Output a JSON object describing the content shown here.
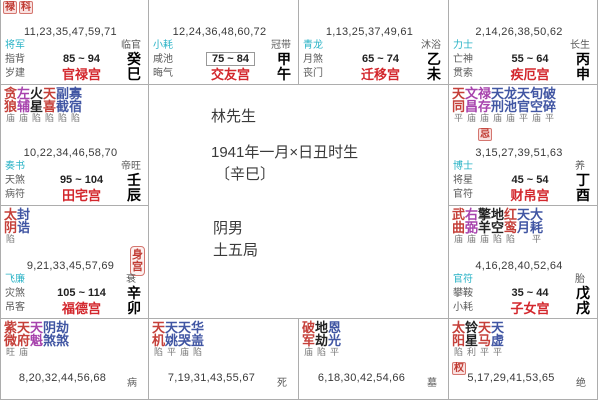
{
  "colors": {
    "star_main": "#c5403a",
    "star_lucky": "#a743ad",
    "star_malefic": "#222222",
    "star_minor": "#4156a3",
    "god_first": "#2ab3c6",
    "palace_red": "#d3272d",
    "badge_red": "#c03a32",
    "border": "#adadad"
  },
  "center": {
    "name": "林先生",
    "birth_line": "1941年一月×日丑时生",
    "birth_year": "〔辛巳〕",
    "gender": "阴男",
    "bureau": "土五局"
  },
  "palaces": [
    {
      "key": "guanlu",
      "row": 1,
      "col": 1,
      "cut": "top",
      "badges": [
        "禄",
        "科"
      ],
      "numbers": "11,23,35,47,59,71",
      "gods": [
        "将军",
        "指背",
        "岁建"
      ],
      "range": "85 ~ 94",
      "stage": "临官",
      "palace": "官禄宫",
      "stem": "癸",
      "branch": "巳"
    },
    {
      "key": "jiaoyou",
      "row": 1,
      "col": 2,
      "cut": "top",
      "numbers": "12,24,36,48,60,72",
      "gods": [
        "小耗",
        "咸池",
        "晦气"
      ],
      "range": "75 ~ 84",
      "range_boxed": true,
      "stage": "冠带",
      "palace": "交友宫",
      "stem": "甲",
      "branch": "午"
    },
    {
      "key": "qianyi",
      "row": 1,
      "col": 3,
      "cut": "top",
      "numbers": "1,13,25,37,49,61",
      "gods": [
        "青龙",
        "月煞",
        "丧门"
      ],
      "range": "65 ~ 74",
      "stage": "沐浴",
      "palace": "迁移宫",
      "stem": "乙",
      "branch": "未"
    },
    {
      "key": "jie",
      "row": 1,
      "col": 4,
      "cut": "top",
      "numbers": "2,14,26,38,50,62",
      "gods": [
        "力士",
        "亡神",
        "贯索"
      ],
      "range": "55 ~ 64",
      "stage": "长生",
      "palace": "疾厄宫",
      "stem": "丙",
      "branch": "申"
    },
    {
      "key": "tianzhai",
      "row": 2,
      "col": 1,
      "stars": [
        {
          "n": "贪狼",
          "c": "main",
          "b": "庙"
        },
        {
          "n": "左辅",
          "c": "lucky",
          "b": "庙"
        },
        {
          "n": "火星",
          "c": "malefic",
          "b": "陷"
        },
        {
          "n": "天喜",
          "c": "main",
          "b": "陷"
        },
        {
          "n": "副截",
          "c": "minor",
          "b": "陷"
        },
        {
          "n": "寡宿",
          "c": "minor",
          "b": "陷"
        }
      ],
      "numbers": "10,22,34,46,58,70",
      "gods": [
        "奏书",
        "天煞",
        "病符"
      ],
      "range": "95 ~ 104",
      "stage": "帝旺",
      "palace": "田宅宫",
      "stem": "壬",
      "branch": "辰"
    },
    {
      "key": "caibo",
      "row": 2,
      "col": 4,
      "stars": [
        {
          "n": "天同",
          "c": "main",
          "b": "平"
        },
        {
          "n": "文昌",
          "c": "lucky",
          "b": "庙"
        },
        {
          "n": "禄存",
          "c": "lucky",
          "b": "庙",
          "badge": "忌"
        },
        {
          "n": "天刑",
          "c": "minor",
          "b": "庙"
        },
        {
          "n": "龙池",
          "c": "minor",
          "b": "庙"
        },
        {
          "n": "天官",
          "c": "minor",
          "b": "平"
        },
        {
          "n": "旬空",
          "c": "minor",
          "b": "庙"
        },
        {
          "n": "破碎",
          "c": "minor",
          "b": "平"
        }
      ],
      "numbers": "3,15,27,39,51,63",
      "gods": [
        "博士",
        "将星",
        "官符"
      ],
      "range": "45 ~ 54",
      "stage": "养",
      "palace": "财帛宫",
      "stem": "丁",
      "branch": "酉"
    },
    {
      "key": "fude",
      "row": 3,
      "col": 1,
      "body_badge": "身宫",
      "stars": [
        {
          "n": "太阴",
          "c": "main",
          "b": "陷"
        },
        {
          "n": "封诰",
          "c": "minor",
          "b": ""
        }
      ],
      "numbers": "9,21,33,45,57,69",
      "gods": [
        "飞廉",
        "灾煞",
        "吊客"
      ],
      "range": "105 ~ 114",
      "stage": "衰",
      "palace": "福德宫",
      "stem": "辛",
      "branch": "卯"
    },
    {
      "key": "zinv",
      "row": 3,
      "col": 4,
      "stars": [
        {
          "n": "武曲",
          "c": "main",
          "b": "庙"
        },
        {
          "n": "右弼",
          "c": "lucky",
          "b": "庙"
        },
        {
          "n": "擎羊",
          "c": "malefic",
          "b": "庙"
        },
        {
          "n": "地空",
          "c": "malefic",
          "b": "陷"
        },
        {
          "n": "红鸾",
          "c": "main",
          "b": "陷"
        },
        {
          "n": "天月",
          "c": "minor",
          "b": ""
        },
        {
          "n": "大耗",
          "c": "minor",
          "b": "平"
        }
      ],
      "numbers": "4,16,28,40,52,64",
      "gods": [
        "官符",
        "攀鞍",
        "小耗"
      ],
      "range": "35 ~ 44",
      "stage": "胎",
      "palace": "子女宫",
      "stem": "戊",
      "branch": "戌"
    },
    {
      "key": "r4c1",
      "row": 4,
      "col": 1,
      "cut": "bottom",
      "stars": [
        {
          "n": "紫微",
          "c": "main",
          "b": "旺"
        },
        {
          "n": "天府",
          "c": "main",
          "b": "庙"
        },
        {
          "n": "天魁",
          "c": "lucky",
          "b": ""
        },
        {
          "n": "阴煞",
          "c": "minor",
          "b": ""
        },
        {
          "n": "劫煞",
          "c": "minor",
          "b": ""
        }
      ],
      "numbers": "8,20,32,44,56,68",
      "stage": "病"
    },
    {
      "key": "r4c2",
      "row": 4,
      "col": 2,
      "cut": "bottom",
      "stars": [
        {
          "n": "天机",
          "c": "main",
          "b": "陷"
        },
        {
          "n": "天姚",
          "c": "minor",
          "b": "平"
        },
        {
          "n": "天哭",
          "c": "minor",
          "b": "庙"
        },
        {
          "n": "华盖",
          "c": "minor",
          "b": "陷"
        }
      ],
      "numbers": "7,19,31,43,55,67",
      "stage": "死"
    },
    {
      "key": "r4c3",
      "row": 4,
      "col": 3,
      "cut": "bottom",
      "stars": [
        {
          "n": "破军",
          "c": "main",
          "b": "庙"
        },
        {
          "n": "地劫",
          "c": "malefic",
          "b": "陷"
        },
        {
          "n": "恩光",
          "c": "minor",
          "b": "平"
        }
      ],
      "numbers": "6,18,30,42,54,66",
      "stage": "墓"
    },
    {
      "key": "r4c4",
      "row": 4,
      "col": 4,
      "cut": "bottom",
      "stars": [
        {
          "n": "太阳",
          "c": "main",
          "b": "陷",
          "badge": "权"
        },
        {
          "n": "铃星",
          "c": "malefic",
          "b": "利"
        },
        {
          "n": "天马",
          "c": "main",
          "b": "平"
        },
        {
          "n": "天虚",
          "c": "minor",
          "b": "平"
        }
      ],
      "numbers": "5,17,29,41,53,65",
      "stage": "绝"
    }
  ]
}
